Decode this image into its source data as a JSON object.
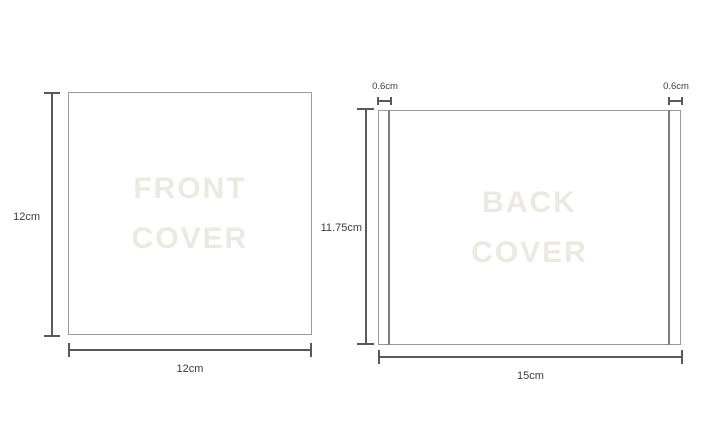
{
  "meta": {
    "description": "Dimension diagram of CD front and back cover artwork"
  },
  "colors": {
    "background": "#ffffff",
    "box_border": "#9a9a9a",
    "dimension_line": "#595959",
    "label_text": "#3d3d3d",
    "watermark_text": "#ebe9e0"
  },
  "front_cover": {
    "watermark_line1": "FRONT",
    "watermark_line2": "COVER",
    "height_label": "12cm",
    "width_label": "12cm"
  },
  "back_cover": {
    "watermark_line1": "BACK",
    "watermark_line2": "COVER",
    "height_label": "11.75cm",
    "width_label": "15cm",
    "left_spine_label": "0.6cm",
    "right_spine_label": "0.6cm"
  }
}
